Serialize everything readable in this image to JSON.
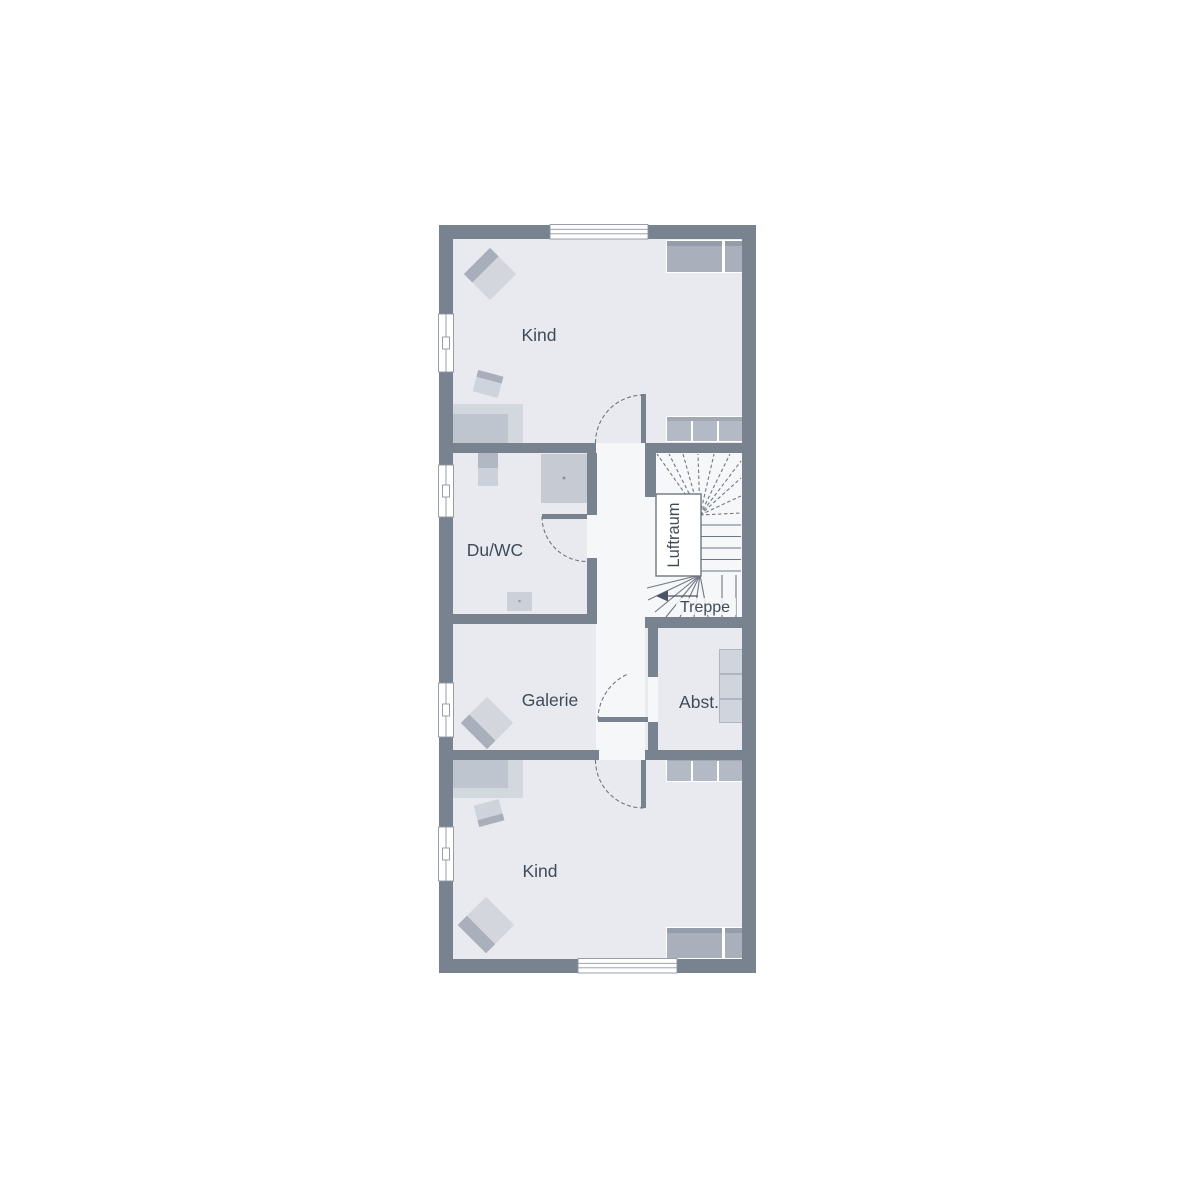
{
  "floorplan": {
    "rooms": {
      "kind_top": {
        "label": "Kind"
      },
      "du_wc": {
        "label": "Du/WC"
      },
      "galerie": {
        "label": "Galerie"
      },
      "abstellraum": {
        "label": "Abst."
      },
      "kind_bottom": {
        "label": "Kind"
      }
    },
    "stairwell": {
      "void_label": "Luftraum",
      "stairs_label": "Treppe"
    },
    "colors": {
      "wall": "#79828f",
      "room_fill": "#e8eaef",
      "circulation_fill": "#f6f7f9",
      "furniture_light": "#d3d6dd",
      "furniture_medium": "#aab0bb",
      "wardrobe_dark": "#a9afbb",
      "wardrobe_light": "#b4bac5",
      "stair_line": "#6f7781",
      "text": "#414b57"
    }
  }
}
